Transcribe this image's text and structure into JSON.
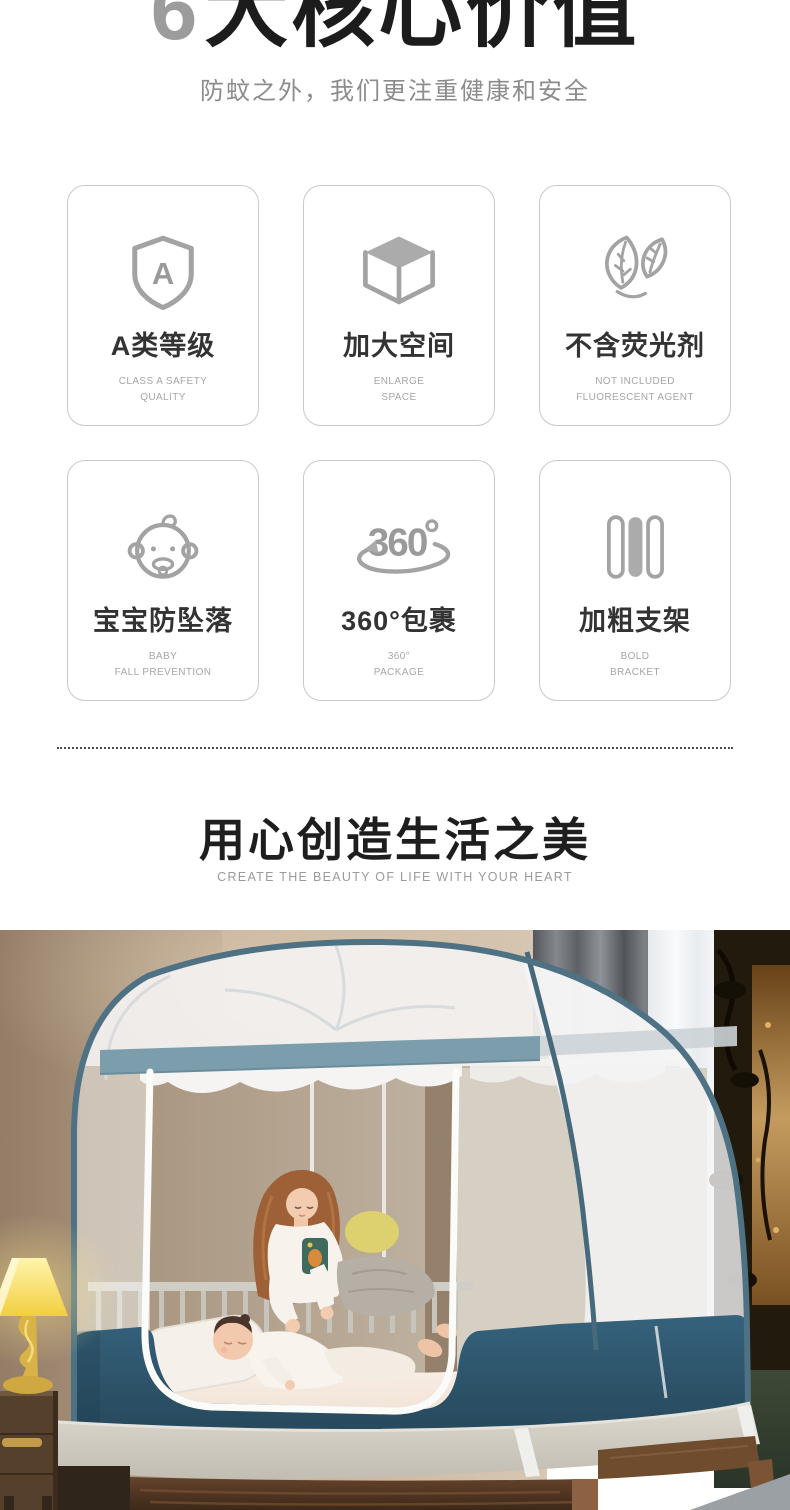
{
  "hero": {
    "number": "6",
    "title": "大核心价值",
    "subtitle": "防蚊之外，我们更注重健康和安全"
  },
  "features": {
    "cards": [
      {
        "icon": "shield-a-icon",
        "title": "A类等级",
        "subtitle_lines": [
          "CLASS A SAFETY",
          "QUALITY"
        ]
      },
      {
        "icon": "cube-icon",
        "title": "加大空间",
        "subtitle_lines": [
          "ENLARGE",
          "SPACE"
        ]
      },
      {
        "icon": "leaves-icon",
        "title": "不含荧光剂",
        "subtitle_lines": [
          "NOT INCLUDED",
          "FLUORESCENT AGENT"
        ]
      },
      {
        "icon": "baby-icon",
        "title": "宝宝防坠落",
        "subtitle_lines": [
          "BABY",
          "FALL PREVENTION"
        ]
      },
      {
        "icon": "rotate-360-icon",
        "title": "360°包裹",
        "subtitle_lines": [
          "360°",
          "PACKAGE"
        ]
      },
      {
        "icon": "bars-icon",
        "title": "加粗支架",
        "subtitle_lines": [
          "BOLD",
          "BRACKET"
        ]
      }
    ]
  },
  "craft_section": {
    "title": "用心创造生活之美",
    "subtitle": "CREATE THE BEAUTY OF LIFE WITH YOUR HEART"
  },
  "photo": {
    "colors": {
      "net_frame": "#4e7183",
      "net_band": "#7b9dac",
      "net_skirt": "#2f586f",
      "lamp_shade": "#f7da4e",
      "wall": "#b69f87"
    }
  }
}
